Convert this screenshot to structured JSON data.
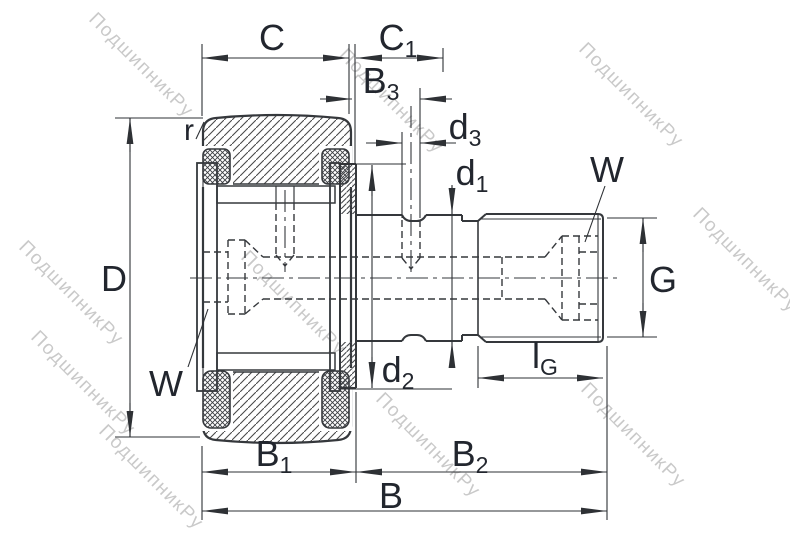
{
  "watermark": {
    "text": "ПодшипникРу"
  },
  "labels": {
    "C": {
      "main": "C"
    },
    "C1": {
      "main": "C",
      "sub": "1"
    },
    "B3": {
      "main": "B",
      "sub": "3"
    },
    "d3": {
      "main": "d",
      "sub": "3"
    },
    "d1": {
      "main": "d",
      "sub": "1"
    },
    "d2": {
      "main": "d",
      "sub": "2"
    },
    "D": {
      "main": "D"
    },
    "G": {
      "main": "G"
    },
    "r": {
      "main": "r"
    },
    "W_right": {
      "main": "W"
    },
    "W_left": {
      "main": "W"
    },
    "lG": {
      "main": "l",
      "sub": "G"
    },
    "B1": {
      "main": "B",
      "sub": "1"
    },
    "B2": {
      "main": "B",
      "sub": "2"
    },
    "B": {
      "main": "B"
    }
  },
  "colors": {
    "line": "#35383c",
    "label": "#22262e",
    "watermark": "#c9c9c9"
  }
}
